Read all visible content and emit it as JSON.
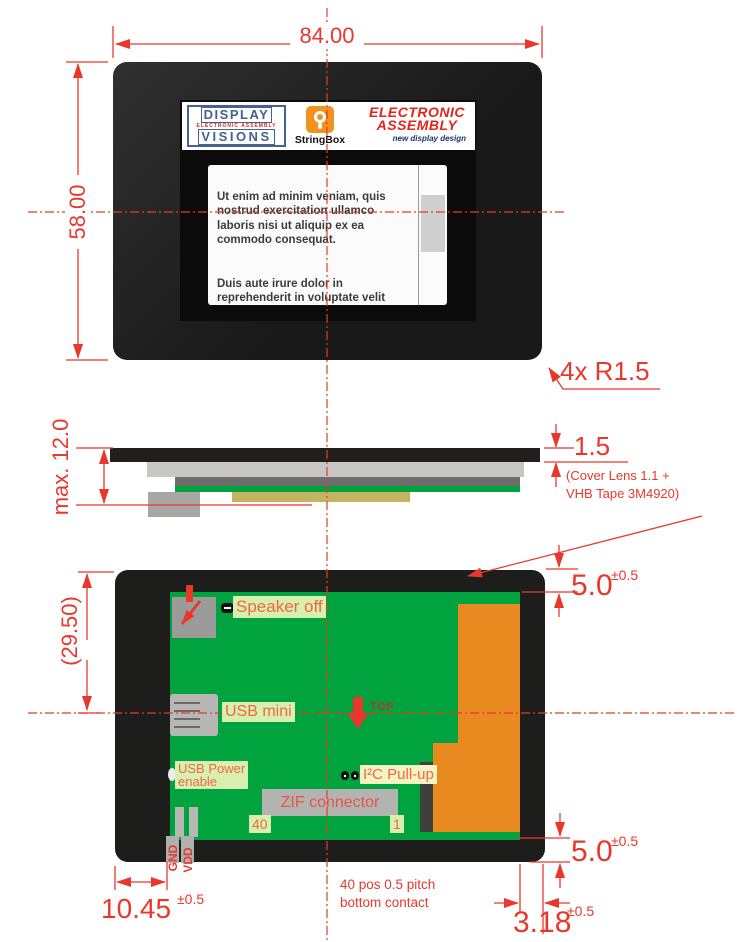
{
  "colors": {
    "dim_red": "#e8382c",
    "label_text": "#ef6747",
    "label_bg": "#d9efad",
    "pcb_green": "#00a33e",
    "comp_orange": "#e98a20",
    "module_black": "#1d1d1b"
  },
  "front_view": {
    "dim_width": "84.00",
    "dim_height": "58.00",
    "corner_radius_note": "4x R1.5",
    "logos": {
      "dv_line1": "DISPLAY",
      "dv_line2": "ELECTRONIC ASSEMBLY",
      "dv_line3": "VISIONS",
      "stringbox_label": "StringBox",
      "ea_line1": "ELECTRONIC",
      "ea_line2": "ASSEMBLY",
      "ea_tagline": "new display design"
    },
    "screen": {
      "para1": "Ut enim ad minim veniam, quis\nnostrud exercitation ullamco\nlaboris nisi ut aliquip ex ea\ncommodo consequat.",
      "para2": "Duis aute irure dolor in\nreprehenderit in voluptate velit"
    }
  },
  "side_view": {
    "dim_total": "max. 12.0",
    "dim_lens": "1.5",
    "lens_note_line1": "(Cover Lens 1.1 +",
    "lens_note_line2": "VHB Tape 3M4920)"
  },
  "back_view": {
    "dim_height": "(29.50)",
    "dim_top": "5.0",
    "dim_top_tol": "±0.5",
    "dim_bottom": "5.0",
    "dim_bottom_tol": "±0.5",
    "dim_left": "10.45",
    "dim_left_tol": "±0.5",
    "dim_contact": "3.18",
    "dim_contact_tol": "±0.5",
    "labels": {
      "speaker": "Speaker off",
      "usb_mini": "USB mini",
      "orientation": "TOP",
      "usb_power_line1": "USB Power",
      "usb_power_line2": "enable",
      "i2c": "I²C Pull-up",
      "zif": "ZIF connector",
      "pin_40": "40",
      "pin_1": "1",
      "gnd": "GND",
      "vdd": "VDD"
    },
    "contact_note_line1": "40 pos 0.5 pitch",
    "contact_note_line2": "bottom contact"
  }
}
